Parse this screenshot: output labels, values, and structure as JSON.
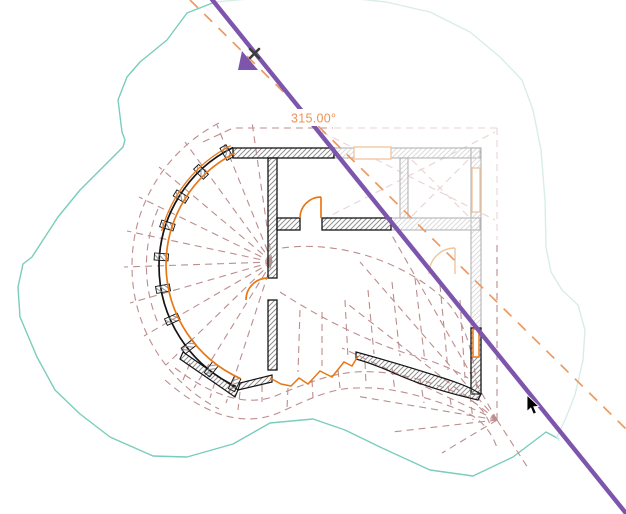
{
  "canvas": {
    "view_type": "floor-plan-rotate-operation",
    "angle_readout": "315.00°"
  },
  "colors": {
    "selection_purple": "#7d55ad",
    "modified_element_orange": "#e87817",
    "ghost_element_orange": "#f2c49a",
    "angle_text_orange": "#ed9258",
    "rotation_ray_orange": "#ec9a62",
    "roof_pattern_rosy": "#bd8d8d",
    "roof_pattern_ghost_pink": "#e9d3d3",
    "site_boundary_teal": "#79cdbb",
    "site_boundary_ghost_teal": "#d9ede8",
    "wall_line_black": "#141414",
    "ghost_wall_gray": "#b3b3b3"
  },
  "icons": {
    "rotate_origin_marker": "purple-flag-triangle",
    "cancel_x_marker": "bold-x",
    "pointer": "arrow-cursor"
  }
}
